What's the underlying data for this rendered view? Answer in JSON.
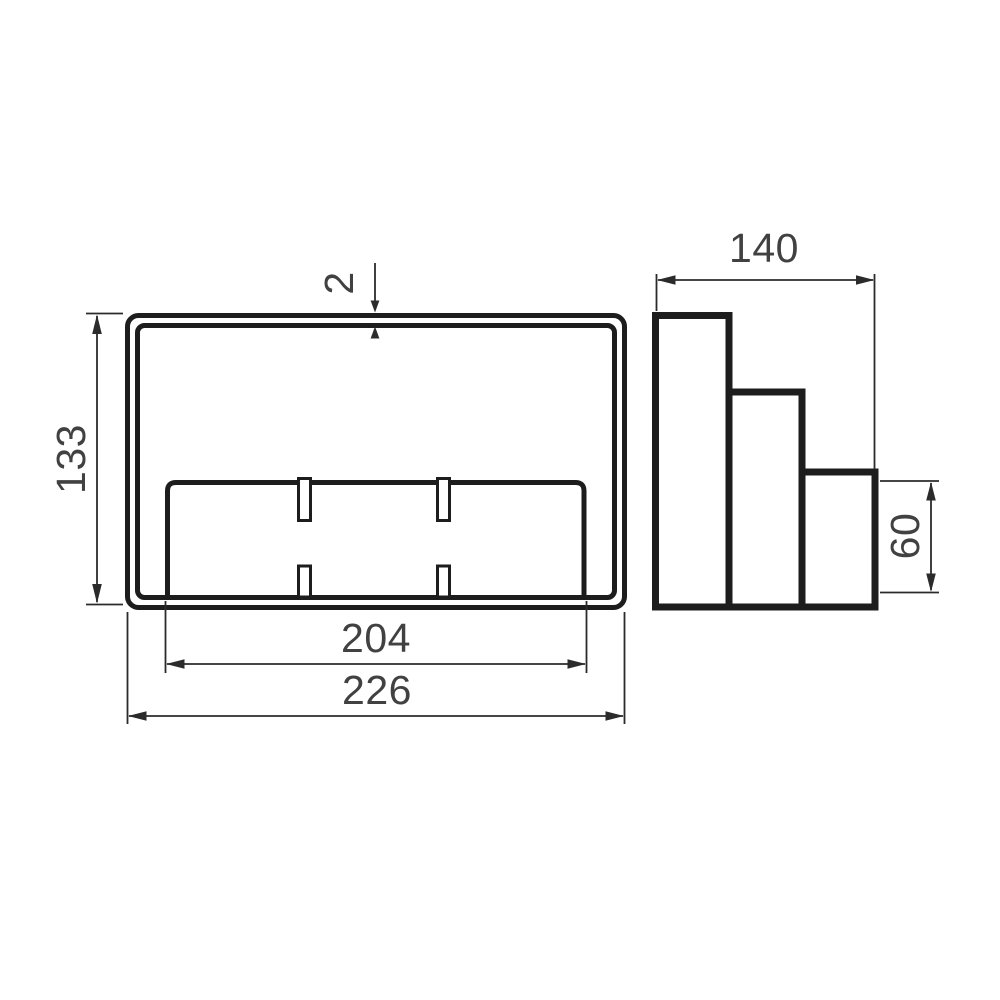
{
  "page": {
    "background": "#ffffff"
  },
  "colors": {
    "bg": "#ffffff",
    "outline": "#1d1d1d",
    "dim": "#2b2b2b",
    "label": "#414141"
  },
  "drawing": {
    "type": "technical-orthographic-drawing",
    "views": {
      "front": {
        "name": "front view",
        "features": [
          "double-wall rounded frame",
          "inner slotted panel",
          "four mounting slots"
        ]
      },
      "side": {
        "name": "side view",
        "features": [
          "three-step profile"
        ]
      }
    },
    "dimensions": {
      "wall_thickness": "2",
      "front_height": "133",
      "inner_width": "204",
      "outer_width": "226",
      "side_depth": "140",
      "step_height": "60"
    }
  }
}
